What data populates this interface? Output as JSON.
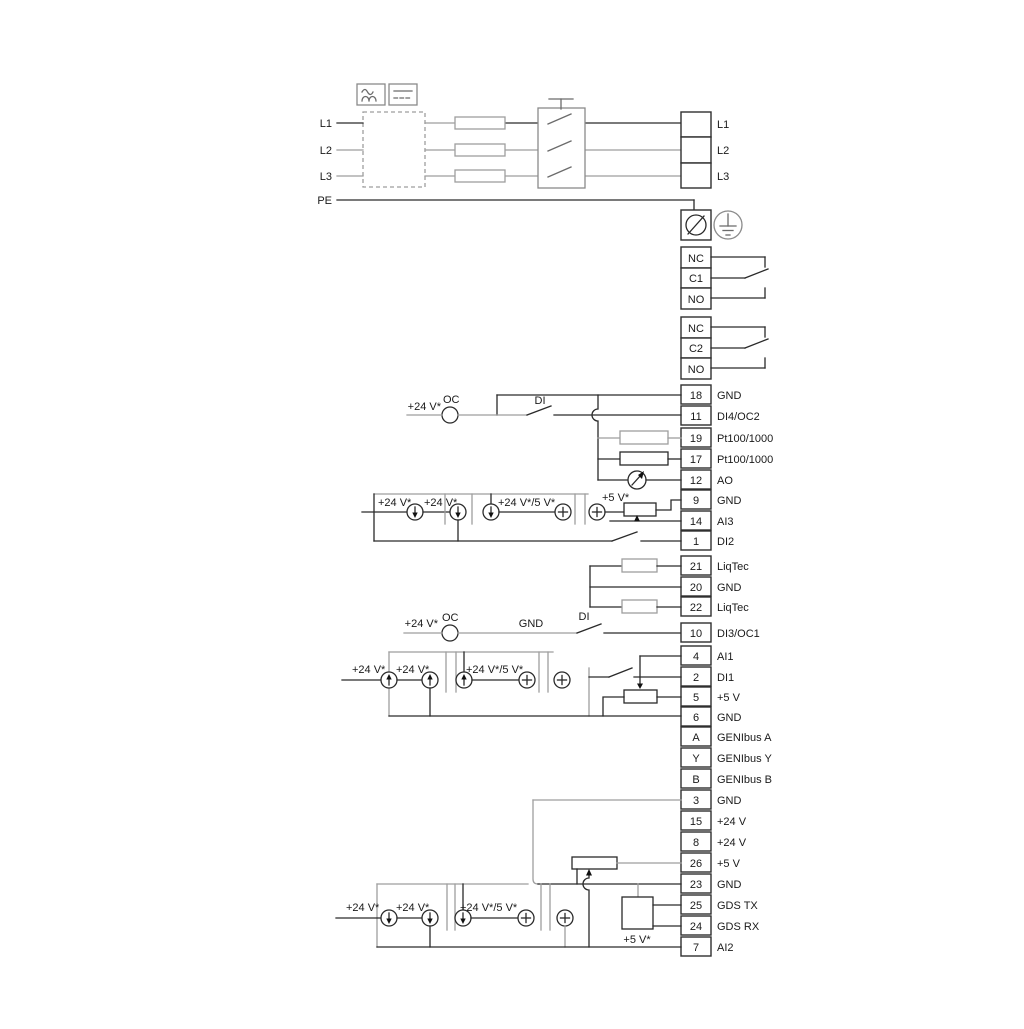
{
  "diagram_title": "Drive wiring and terminal connection diagram",
  "colors": {
    "wire_dark": "#2a2a2a",
    "wire_gray": "#9e9e9e",
    "background": "#ffffff"
  },
  "power": {
    "inputs": [
      "L1",
      "L2",
      "L3",
      "PE"
    ],
    "out_labels": [
      "L1",
      "L2",
      "L3"
    ]
  },
  "relay1": [
    "NC",
    "C1",
    "NO"
  ],
  "relay2": [
    "NC",
    "C2",
    "NO"
  ],
  "strips": {
    "io": [
      {
        "num": "18",
        "label": "GND"
      },
      {
        "num": "11",
        "label": "DI4/OC2"
      },
      {
        "num": "19",
        "label": "Pt100/1000"
      },
      {
        "num": "17",
        "label": "Pt100/1000"
      },
      {
        "num": "12",
        "label": "AO"
      },
      {
        "num": "9",
        "label": "GND"
      },
      {
        "num": "14",
        "label": "AI3"
      },
      {
        "num": "1",
        "label": "DI2"
      }
    ],
    "liqtec": [
      {
        "num": "21",
        "label": "LiqTec"
      },
      {
        "num": "20",
        "label": "GND"
      },
      {
        "num": "22",
        "label": "LiqTec"
      }
    ],
    "comm": [
      {
        "num": "10",
        "label": "DI3/OC1"
      },
      {
        "num": "4",
        "label": "AI1"
      },
      {
        "num": "2",
        "label": "DI1"
      },
      {
        "num": "5",
        "label": "+5 V"
      },
      {
        "num": "6",
        "label": "GND"
      },
      {
        "num": "A",
        "label": "GENIbus A"
      },
      {
        "num": "Y",
        "label": "GENIbus Y"
      },
      {
        "num": "B",
        "label": "GENIbus B"
      }
    ],
    "bottom": [
      {
        "num": "3",
        "label": "GND"
      },
      {
        "num": "15",
        "label": "+24 V"
      },
      {
        "num": "8",
        "label": "+24 V"
      },
      {
        "num": "26",
        "label": "+5 V"
      },
      {
        "num": "23",
        "label": "GND"
      },
      {
        "num": "25",
        "label": "GDS TX"
      },
      {
        "num": "24",
        "label": "GDS RX"
      },
      {
        "num": "7",
        "label": "AI2"
      }
    ]
  },
  "wire_labels": {
    "di4_row": {
      "supply": "+24 V*",
      "oc": "OC",
      "di": "DI"
    },
    "ai3_row": {
      "s1": "+24 V*",
      "s2": "+24 V*",
      "s3": "+24 V*/5 V*",
      "s4": "+5 V*"
    },
    "di3_row": {
      "supply": "+24 V*",
      "oc": "OC",
      "gnd": "GND",
      "di": "DI"
    },
    "ai1_row": {
      "s1": "+24 V*",
      "s2": "+24 V*",
      "s3": "+24 V*/5 V*"
    },
    "ai2_row": {
      "s1": "+24 V*",
      "s2": "+24 V*",
      "s3": "+24 V*/5 V*",
      "s4": "+5 V*"
    }
  }
}
